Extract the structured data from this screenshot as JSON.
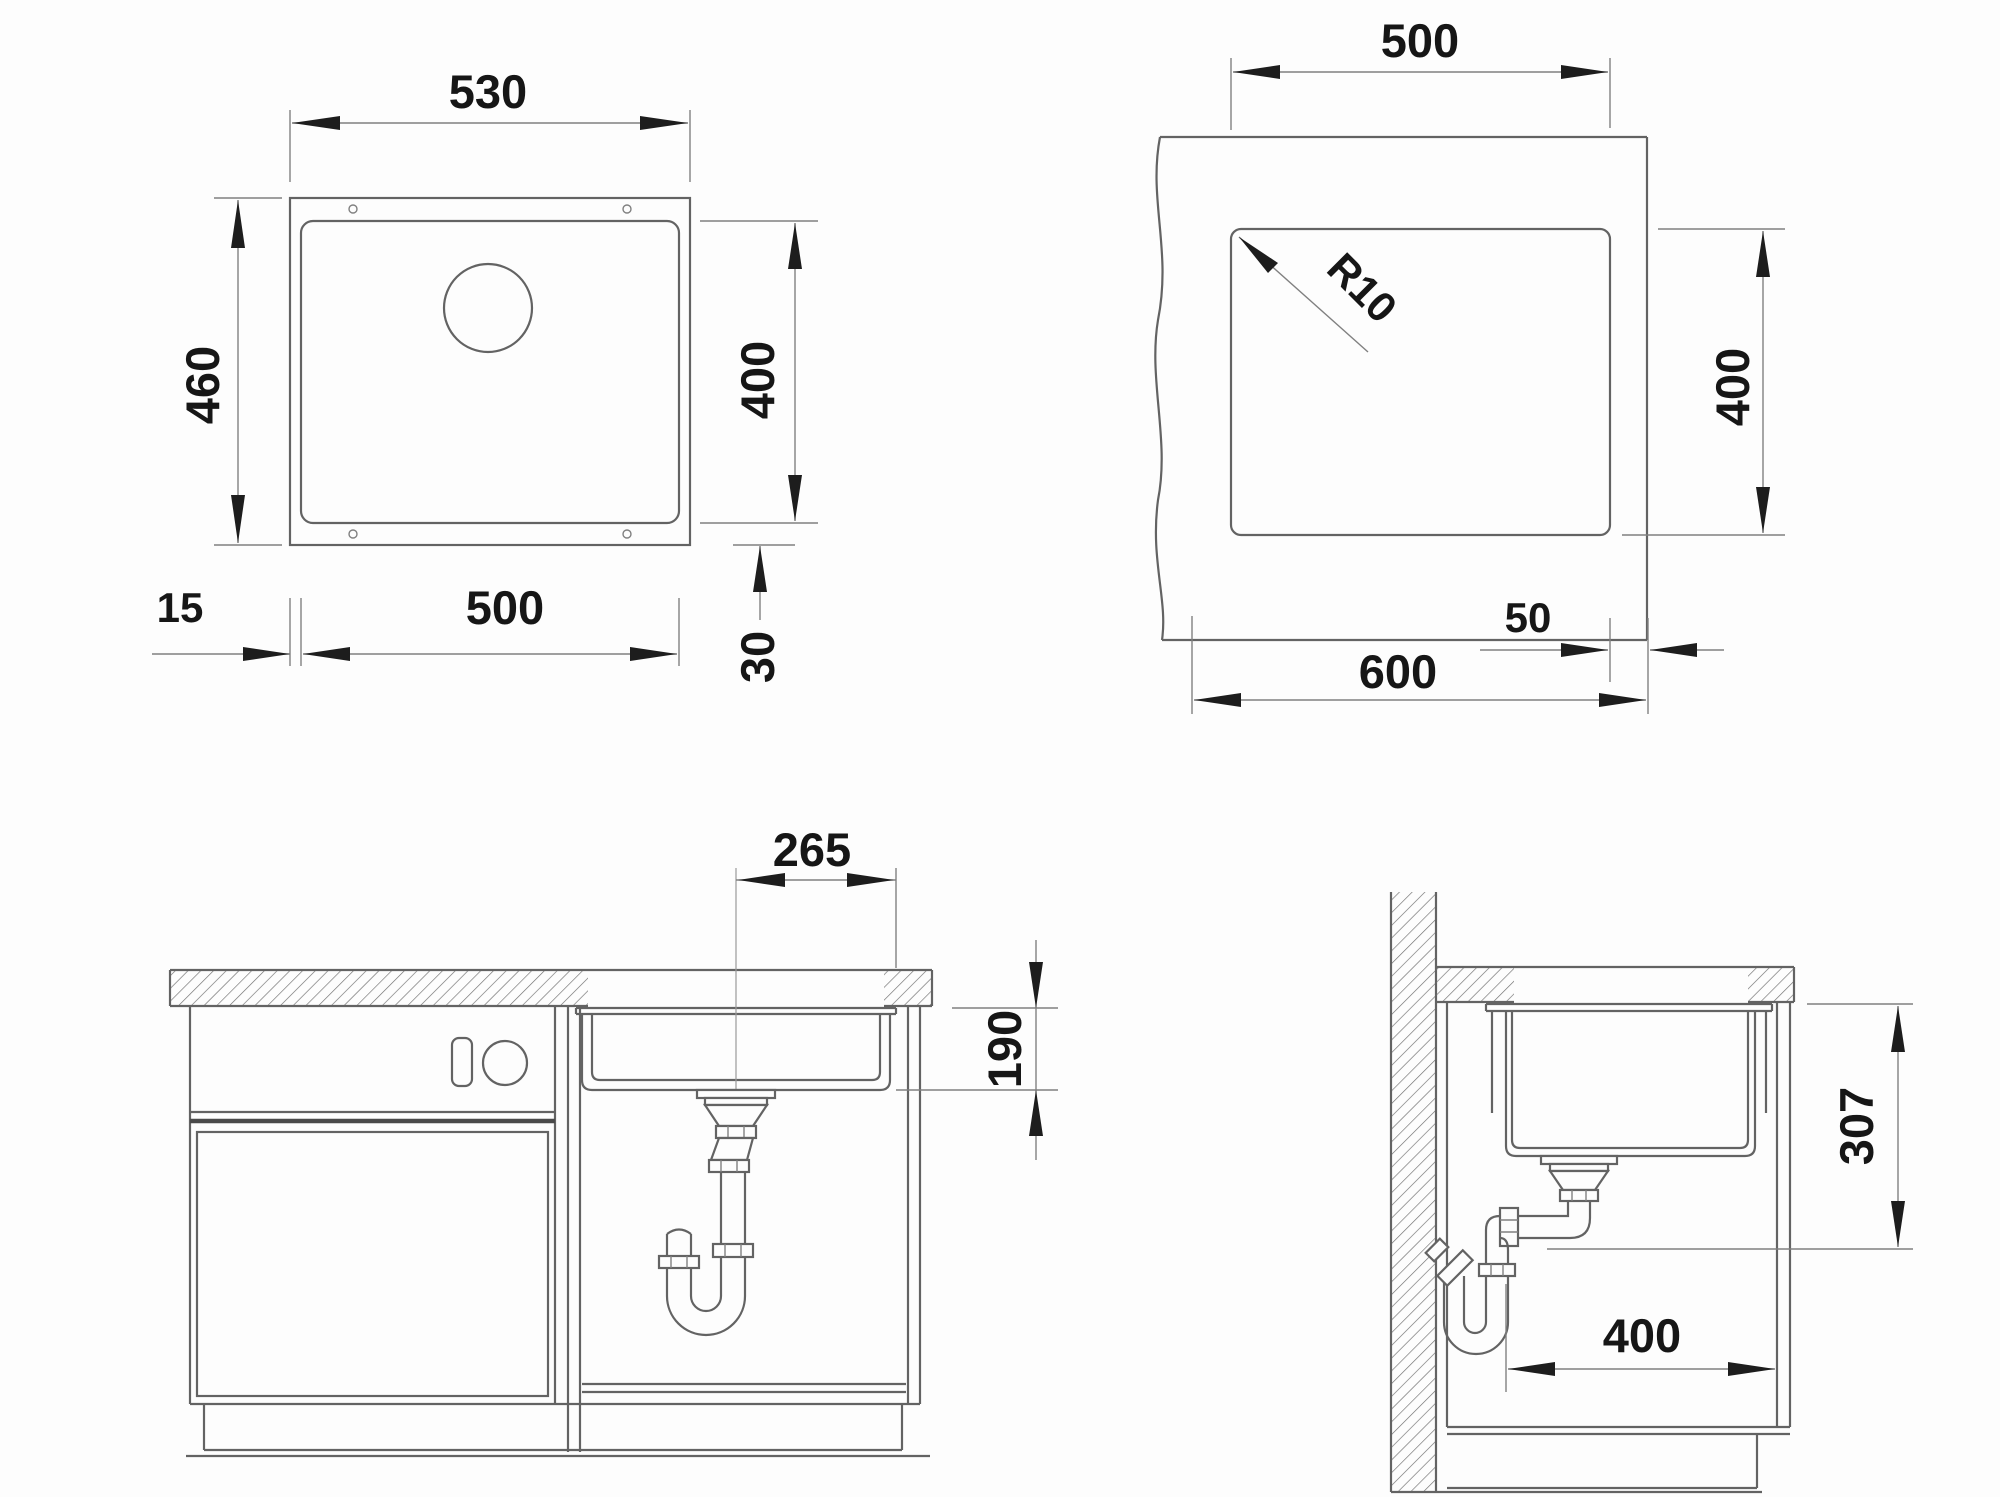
{
  "drawing": {
    "background": "#fdfdfd",
    "line_color": "#636363",
    "text_color": "#161616",
    "views": {
      "sink_plan": {
        "overall_width": "530",
        "overall_depth": "460",
        "bowl_width": "500",
        "bowl_depth": "400",
        "rim_offset_side": "15",
        "rim_offset_bottom": "30"
      },
      "cutout_plan": {
        "cutout_width": "500",
        "cutout_depth": "400",
        "corner_radius": "R10",
        "edge_distance": "50",
        "cabinet_width": "600"
      },
      "front_section": {
        "drain_center_offset": "265",
        "bowl_inner_depth": "190"
      },
      "side_section": {
        "drain_outlet_drop": "307",
        "clearance_depth": "400"
      }
    }
  }
}
